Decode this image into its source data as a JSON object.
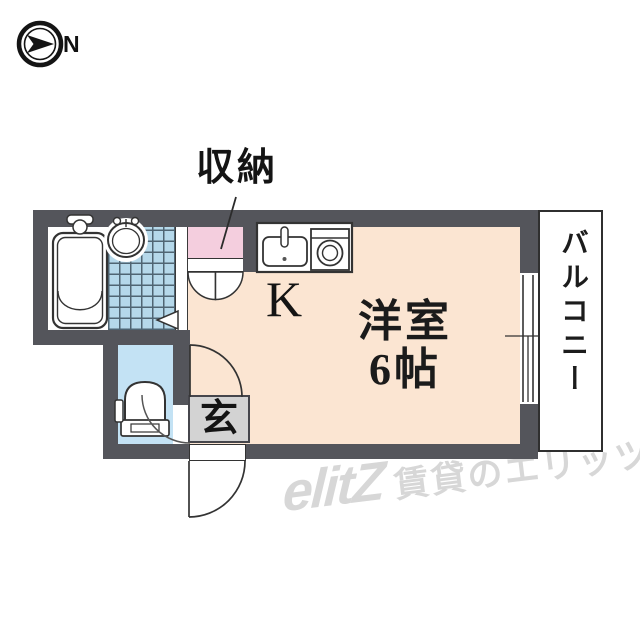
{
  "compass": {
    "label": "N"
  },
  "rooms": {
    "closet_label": "収納",
    "kitchen_label": "K",
    "main_room_name": "洋室",
    "main_room_size": "6帖",
    "balcony_label": "バルコニー",
    "entrance_label": "玄"
  },
  "watermark": {
    "logo": "elitZ",
    "caption": "賃貸のエリッツ"
  },
  "icons": [
    "compass-icon",
    "bathtub-icon",
    "washbasin-icon",
    "toilet-icon",
    "kitchen-sink-icon",
    "stove-icon",
    "door-swing-arc",
    "sliding-window",
    "door-triangle"
  ],
  "colors": {
    "wall": "#54555b",
    "room_floor": "#fbe5d2",
    "closet": "#f4cede",
    "bath_tile": "#b5d8ea",
    "toilet_floor": "#c3e2f4",
    "entrance_box": "#d3d3d3",
    "watermark": "#d7d7d7"
  }
}
